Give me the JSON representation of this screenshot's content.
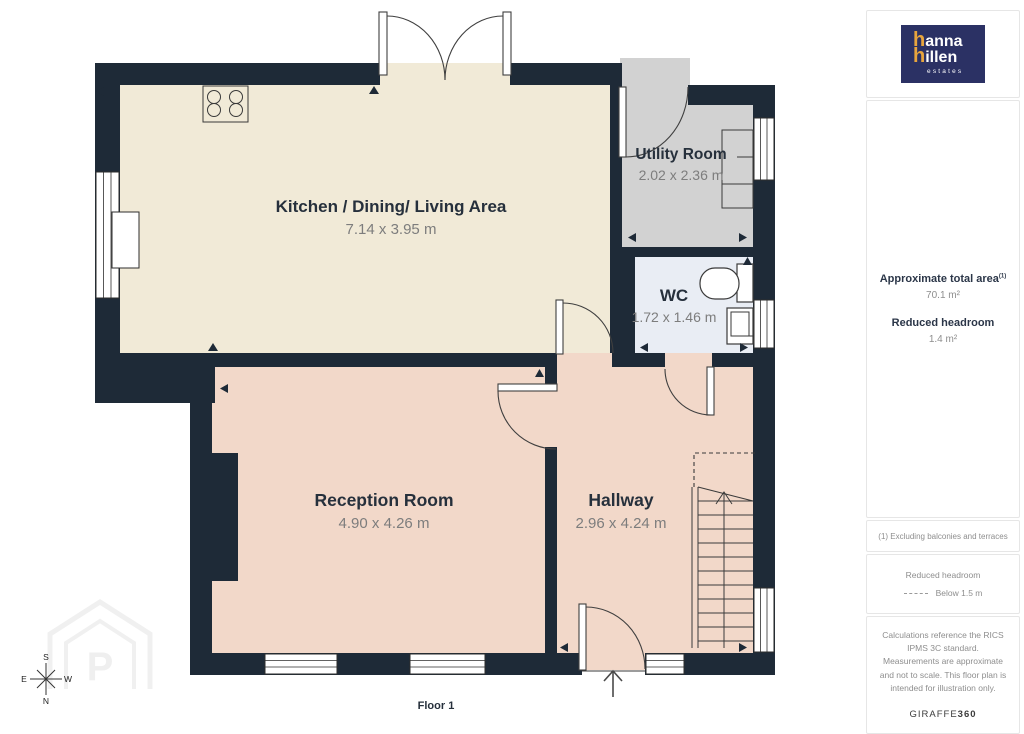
{
  "colors": {
    "wall": "#1e2a37",
    "kitchen": "#f1ead7",
    "utility": "#d2d2d2",
    "wc": "#e9edf4",
    "lounge": "#f2d8c9",
    "label": "#26303c",
    "dims": "#7d7d7d",
    "logoNavy": "#2b3164",
    "accentYellow": "#e8a53d"
  },
  "plan": {
    "floor_label": "Floor 1",
    "watermark_letter": "P",
    "rooms": [
      {
        "name": "Kitchen / Dining/ Living Area",
        "dims": "7.14 x 3.95 m"
      },
      {
        "name": "Utility Room",
        "dims": "2.02 x 2.36 m"
      },
      {
        "name": "WC",
        "dims": "1.72 x 1.46 m"
      },
      {
        "name": "Reception Room",
        "dims": "4.90 x 4.26 m"
      },
      {
        "name": "Hallway",
        "dims": "2.96 x 4.24 m"
      }
    ],
    "compass": {
      "top": "S",
      "bottom": "N",
      "left": "E",
      "right": "W"
    }
  },
  "sidebar": {
    "logo": {
      "h1": "h",
      "rest1": "anna",
      "h2": "h",
      "rest2": "illen",
      "tagline": "estates"
    },
    "area_heading": "Approximate total area",
    "area_superscript": "(1)",
    "area_value": "70.1 m²",
    "headroom_heading": "Reduced headroom",
    "headroom_value": "1.4 m²",
    "footnote": "(1) Excluding balconies and terraces",
    "legend_title": "Reduced headroom",
    "legend_item": "Below 1.5 m",
    "disclaimer": "Calculations reference the RICS IPMS 3C standard. Measurements are approximate and not to scale. This floor plan is intended for illustration only.",
    "brand_name": "GIRAFFE",
    "brand_suffix": "360"
  }
}
